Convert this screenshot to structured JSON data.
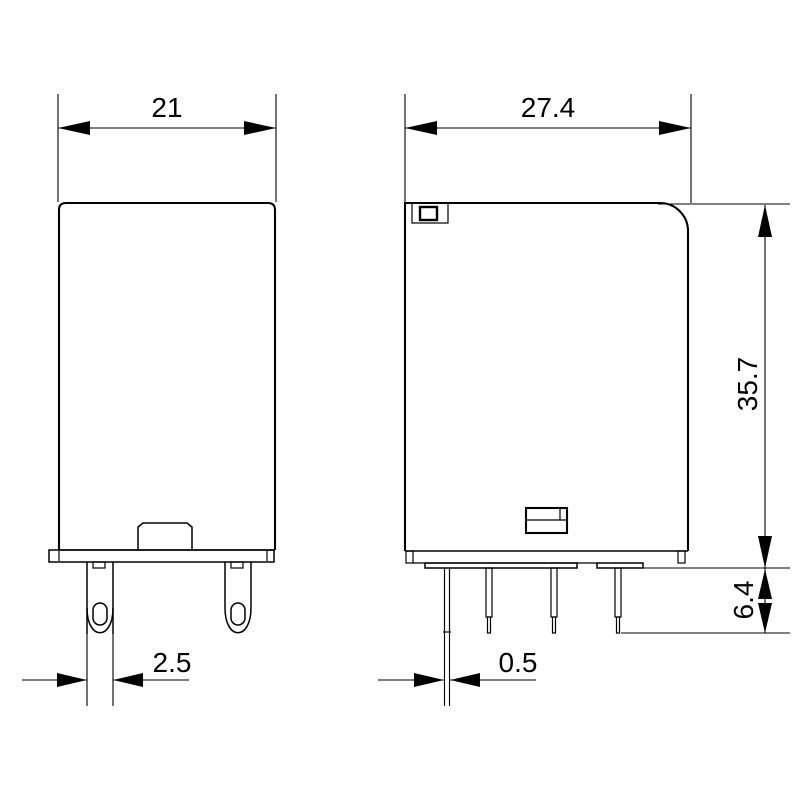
{
  "colors": {
    "line": "#000000",
    "background": "#ffffff"
  },
  "dimensions": {
    "front_width": "21",
    "side_width": "27.4",
    "body_height": "35.7",
    "terminal_length": "6.4",
    "front_pin_width": "2.5",
    "side_pin_thickness": "0.5"
  }
}
